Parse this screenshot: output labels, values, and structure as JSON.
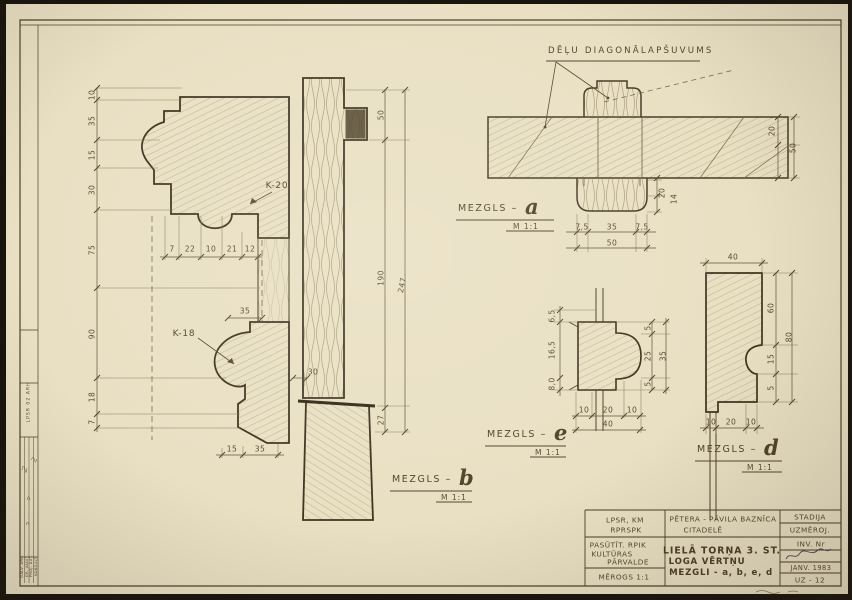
{
  "sheet": {
    "annotation": "DĒĻU DIAGONĀLAPŠUVUMS"
  },
  "details": [
    {
      "label": "MEZGLS –",
      "letter": "a",
      "scale": "M 1:1"
    },
    {
      "label": "MEZGLS –",
      "letter": "b",
      "scale": "M 1:1"
    },
    {
      "label": "MEZGLS –",
      "letter": "e",
      "scale": "M 1:1"
    },
    {
      "label": "MEZGLS –",
      "letter": "d",
      "scale": "M 1:1"
    }
  ],
  "titleblock": {
    "org_line1": "LPSR, KM",
    "org_line2": "RPRSPK",
    "project_line1": "PĒTERA - PĀVILA BAZNĪCA",
    "project_line2": "CITADELĒ",
    "client_line1": "PASŪTĪT. RPIK",
    "client_line2": "KULTŪRAS",
    "client_line3": "PĀRVALDE",
    "scale": "MĒROGS 1:1",
    "title_line1": "LIELĀ TORŅA 3. ST.",
    "title_line2": "LOGA VĒRTŅU",
    "title_line3": "MEZGLI - a, b, e, d",
    "stage_label": "STADIJA",
    "stage_value": "UZMĒROJ.",
    "inv_label": "INV. Nr",
    "date": "JANV. 1983",
    "sheet_no": "UZ - 12"
  },
  "leftblock": {
    "stamp": "LPSR 02 ARH",
    "roles": [
      "GALV. ARH.",
      "GR. VADĪT.",
      "PROJ. AUT.",
      "KONSULT."
    ]
  },
  "dims": [
    {
      "t": "10",
      "x": 92,
      "y": 95,
      "r": -90
    },
    {
      "t": "35",
      "x": 92,
      "y": 121,
      "r": -90
    },
    {
      "t": "15",
      "x": 92,
      "y": 155,
      "r": -90
    },
    {
      "t": "30",
      "x": 92,
      "y": 190,
      "r": -90
    },
    {
      "t": "75",
      "x": 92,
      "y": 250,
      "r": -90
    },
    {
      "t": "90",
      "x": 92,
      "y": 334,
      "r": -90
    },
    {
      "t": "18",
      "x": 92,
      "y": 397,
      "r": -90
    },
    {
      "t": "7",
      "x": 92,
      "y": 422,
      "r": -90
    },
    {
      "t": "7",
      "x": 172,
      "y": 249
    },
    {
      "t": "22",
      "x": 190,
      "y": 249
    },
    {
      "t": "10",
      "x": 211,
      "y": 249
    },
    {
      "t": "21",
      "x": 232,
      "y": 249
    },
    {
      "t": "12",
      "x": 250,
      "y": 249
    },
    {
      "t": "50",
      "x": 381,
      "y": 115,
      "r": -90
    },
    {
      "t": "190",
      "x": 381,
      "y": 278,
      "r": -90
    },
    {
      "t": "247",
      "x": 402,
      "y": 285,
      "r": -78
    },
    {
      "t": "27",
      "x": 381,
      "y": 420,
      "r": -90
    },
    {
      "t": "35",
      "x": 245,
      "y": 311
    },
    {
      "t": "30",
      "x": 313,
      "y": 372
    },
    {
      "t": "15",
      "x": 232,
      "y": 449
    },
    {
      "t": "35",
      "x": 260,
      "y": 449
    },
    {
      "t": "K-20",
      "x": 277,
      "y": 186,
      "cls": "part"
    },
    {
      "t": "K-18",
      "x": 184,
      "y": 334,
      "cls": "part"
    },
    {
      "t": "7,5",
      "x": 582,
      "y": 227
    },
    {
      "t": "35",
      "x": 612,
      "y": 227
    },
    {
      "t": "7,5",
      "x": 642,
      "y": 227
    },
    {
      "t": "50",
      "x": 612,
      "y": 243
    },
    {
      "t": "20",
      "x": 662,
      "y": 193,
      "r": -90
    },
    {
      "t": "14",
      "x": 674,
      "y": 199,
      "r": -90
    },
    {
      "t": "20",
      "x": 772,
      "y": 131,
      "r": -90
    },
    {
      "t": "50",
      "x": 793,
      "y": 148,
      "r": -90
    },
    {
      "t": "6,5",
      "x": 552,
      "y": 316,
      "r": -90
    },
    {
      "t": "16,5",
      "x": 552,
      "y": 350,
      "r": -90
    },
    {
      "t": "8,0",
      "x": 552,
      "y": 384,
      "r": -90
    },
    {
      "t": "5",
      "x": 648,
      "y": 328,
      "r": -90
    },
    {
      "t": "25",
      "x": 648,
      "y": 356,
      "r": -90
    },
    {
      "t": "5",
      "x": 648,
      "y": 384,
      "r": -90
    },
    {
      "t": "35",
      "x": 663,
      "y": 356,
      "r": -90
    },
    {
      "t": "10",
      "x": 584,
      "y": 410
    },
    {
      "t": "20",
      "x": 608,
      "y": 410
    },
    {
      "t": "10",
      "x": 632,
      "y": 410
    },
    {
      "t": "40",
      "x": 608,
      "y": 424
    },
    {
      "t": "40",
      "x": 733,
      "y": 257
    },
    {
      "t": "60",
      "x": 771,
      "y": 308,
      "r": -90
    },
    {
      "t": "15",
      "x": 771,
      "y": 359,
      "r": -90
    },
    {
      "t": "5",
      "x": 771,
      "y": 388,
      "r": -90
    },
    {
      "t": "80",
      "x": 789,
      "y": 337,
      "r": -90
    },
    {
      "t": "10",
      "x": 711,
      "y": 422
    },
    {
      "t": "20",
      "x": 731,
      "y": 422
    },
    {
      "t": "10",
      "x": 751,
      "y": 422
    }
  ]
}
